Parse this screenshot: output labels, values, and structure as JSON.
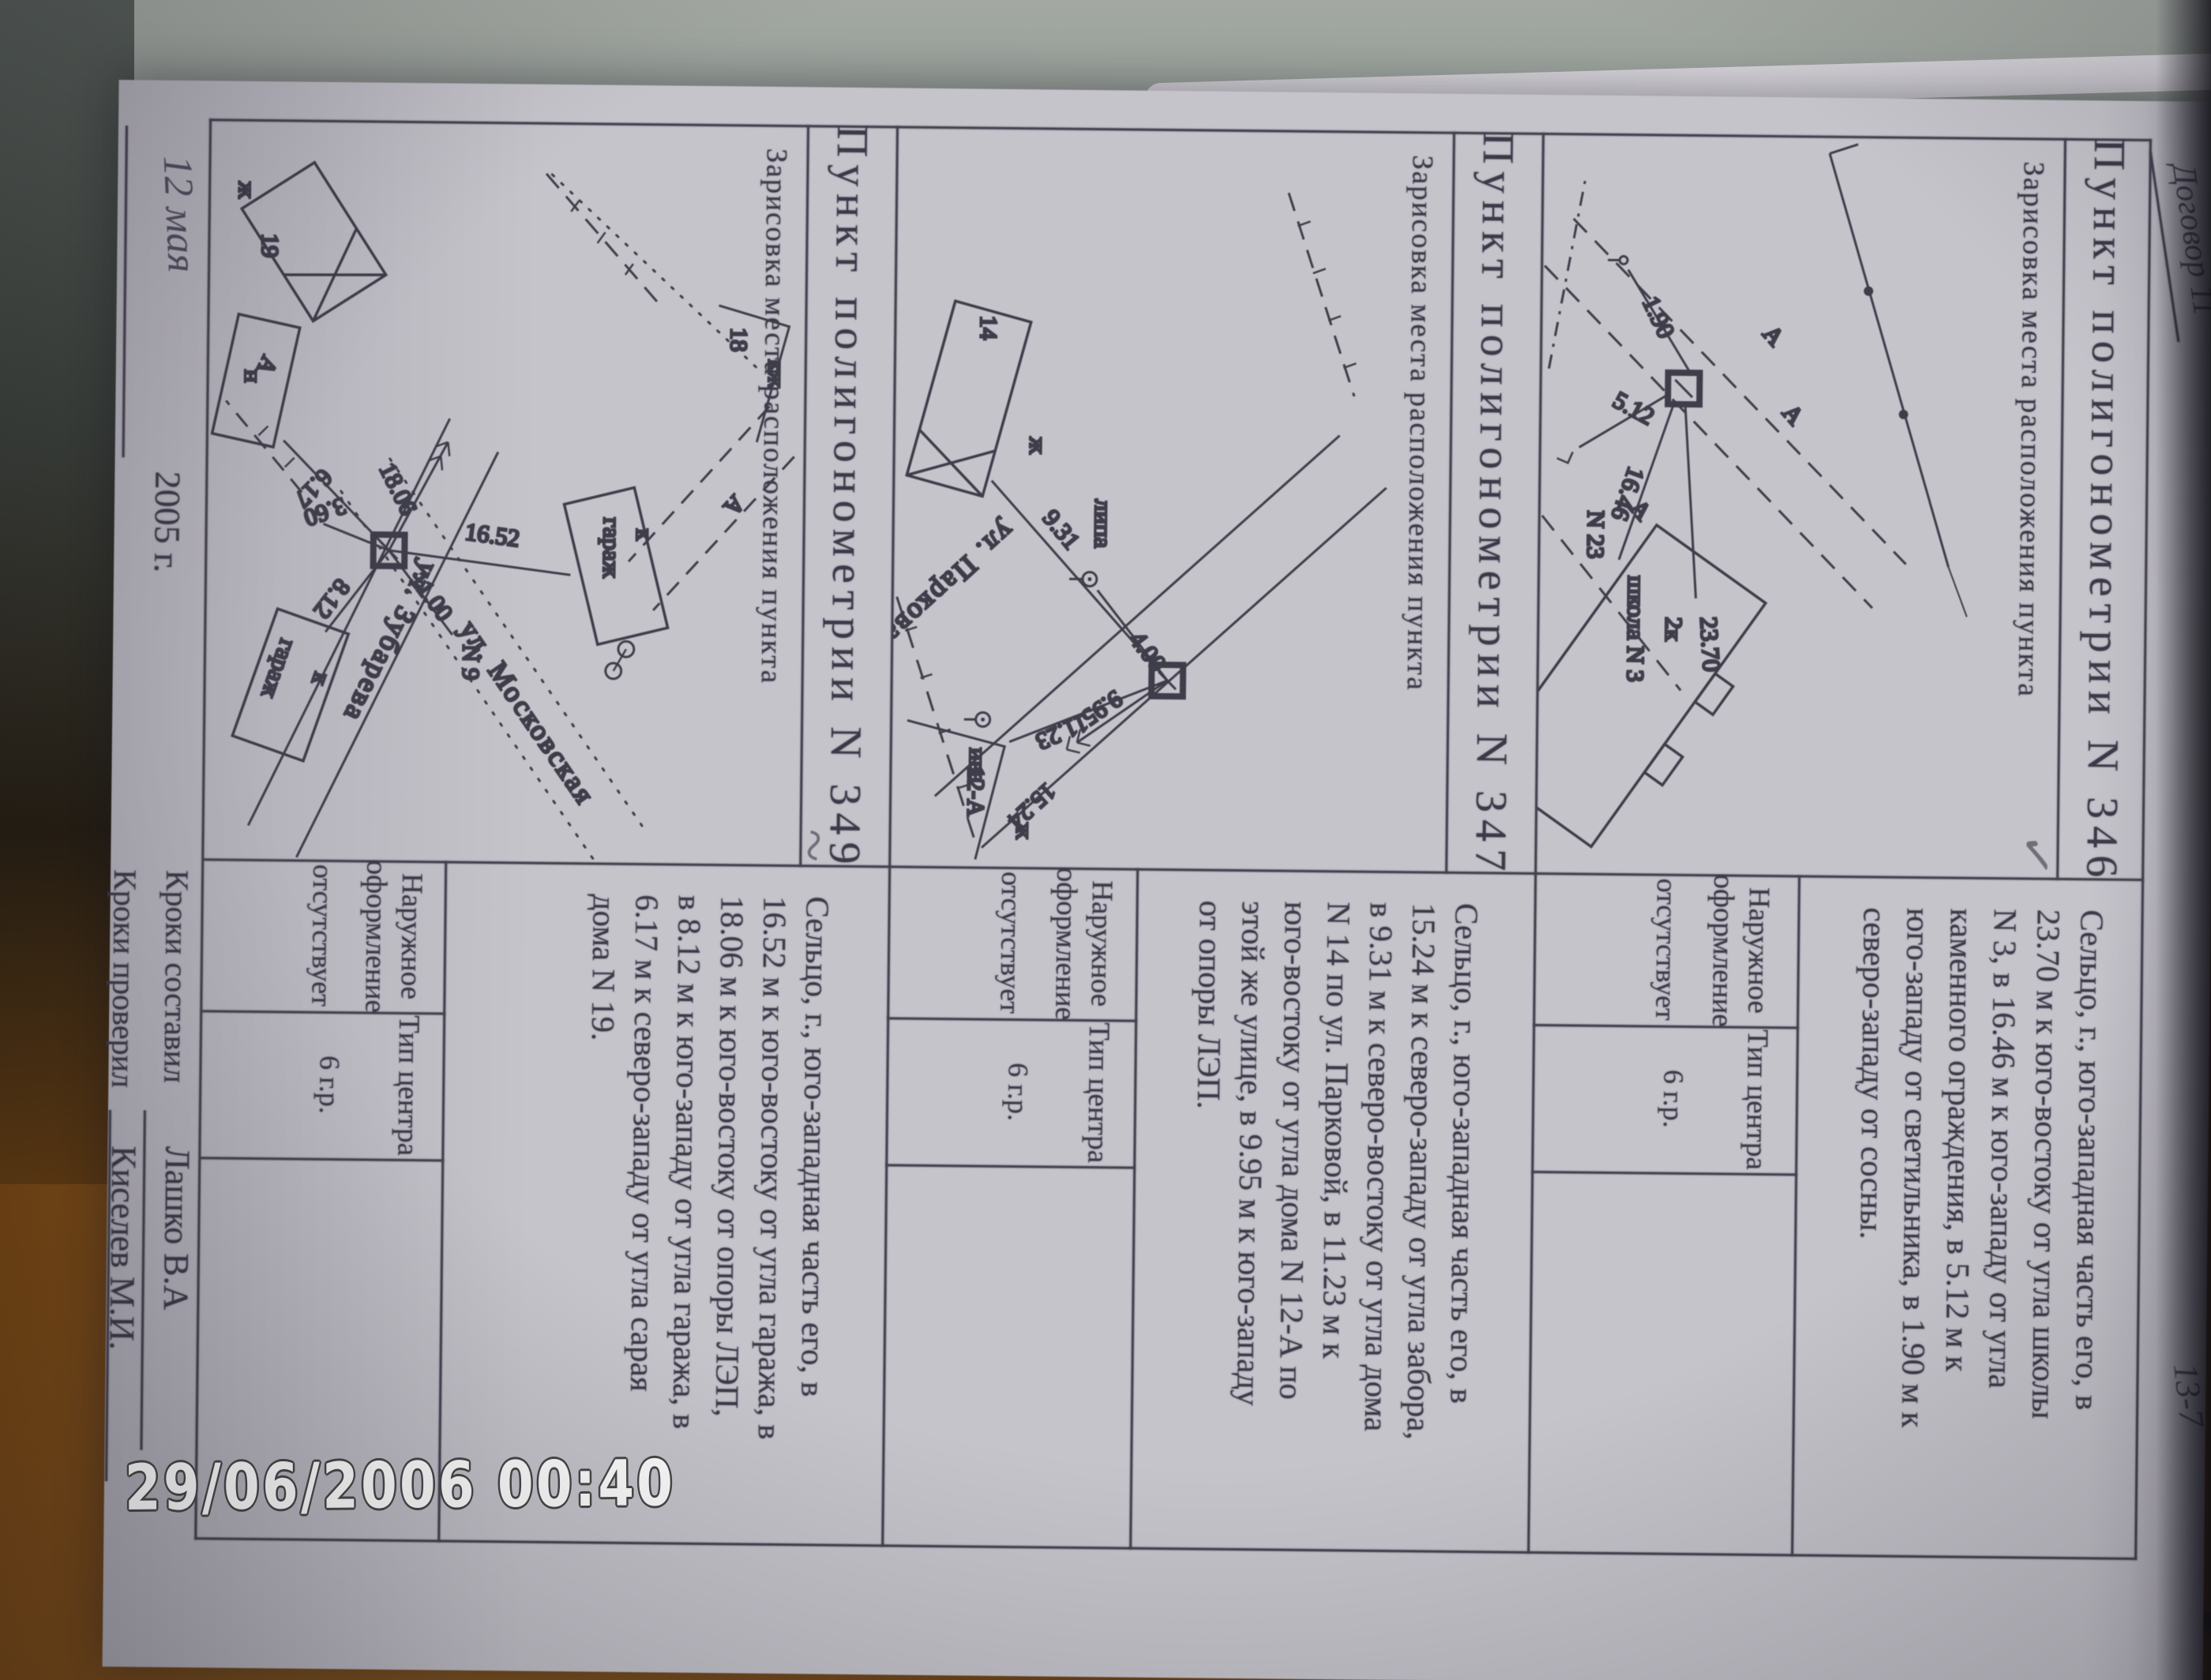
{
  "photo": {
    "timestamp": "29/06/2006  00:40"
  },
  "colors": {
    "page": "#c6c4cb",
    "ink": "#3b3a48",
    "wood": "#7d4a14",
    "background_top": "#99a09a",
    "timestamp_fill": "#fcfcfc"
  },
  "page": {
    "corner_note": "Договор 11",
    "page_number": "13-7",
    "footer": {
      "date": "12 мая",
      "year": "2005 г.",
      "made_label": "Кроки составил",
      "made_name": "Лашко В.А",
      "checked_label": "Кроки проверил",
      "checked_name": "Киселев М.И."
    },
    "records": [
      {
        "title": "Пункт полигонометрии N 346",
        "mark": "✓",
        "sketch_caption": "Зарисовка места расположения пункта",
        "description_lines": [
          "Сельцо, г., юго-западная часть его, в",
          "23.70 м к юго-востоку от угла школы",
          "N 3,  в 16.46 м к юго-западу от угла",
          "каменного ограждения, в 5.12 м к",
          "юго-западу от светильника, в 1.90 м к",
          "северо-западу от сосны."
        ],
        "outer_label_1": "Наружное",
        "outer_label_2": "оформление",
        "outer_value": "отсутствует",
        "center_label": "Тип центра",
        "center_value": "6 г.р.",
        "sketch_labels": {
          "d1": "23.70",
          "d2": "16.46",
          "d3": "5.12",
          "d4": "1.90",
          "a1": "А",
          "a2": "А",
          "a3": "А",
          "house_no": "N 23",
          "bld1": "2к",
          "bld2": "школа N 3"
        }
      },
      {
        "title": "Пункт полигонометрии N 347",
        "mark": "",
        "sketch_caption": "Зарисовка места расположения пункта",
        "description_lines": [
          "Сельцо, г., юго-западная часть его, в",
          "15.24 м к северо-западу от угла забора,",
          "в 9.31 м к северо-востоку от угла дома",
          "N 14 по ул. Парковой, в 11.23 м к",
          "юго-востоку от угла дома N 12-А по",
          "этой же улице, в 9.95 м к юго-западу",
          "от опоры ЛЭП."
        ],
        "outer_label_1": "Наружное",
        "outer_label_2": "оформление",
        "outer_value": "отсутствует",
        "center_label": "Тип центра",
        "center_value": "6 г.р.",
        "sketch_labels": {
          "b14": "14",
          "zh1": "ж",
          "d1": "9.31",
          "tree1": "липа",
          "d2": "4.00",
          "d3": "11.23",
          "b12": "12-А",
          "zh2": "ж",
          "d4": "9.95",
          "d5": "15.24",
          "tree2": "ива",
          "street": "ул. Парковая"
        }
      },
      {
        "title": "Пункт полигонометрии N 349",
        "mark": "~",
        "sketch_caption": "Зарисовка места расположения пункта",
        "description_lines": [
          "Сельцо, г., юго-западная часть его, в",
          "16.52 м к юго-востоку от угла гаража, в",
          "18.06 м к юго-востоку от опоры ЛЭП,",
          "в 8.12 м к юго-западу от угла гаража, в",
          "6.17 м к северо-западу от угла сарая",
          "дома N 19."
        ],
        "outer_label_1": "Наружное",
        "outer_label_2": "оформление",
        "outer_value": "отсутствует",
        "center_label": "Тип центра",
        "center_value": "6 г.р.",
        "sketch_labels": {
          "b18a": "кж",
          "b18": "18",
          "a1": "А",
          "g1k": "к",
          "g1": "гараж",
          "n9": "N 9",
          "d1": "16.52",
          "d2": "11.00",
          "d3": "18.06",
          "street1": "ул. Московская",
          "d4": "8.12",
          "d5": "3.60",
          "d6": "6.17",
          "g2k": "к",
          "g2": "гараж",
          "street2": "ул. Зубарева",
          "shed": "н",
          "b19": "19",
          "zh": "ж",
          "a2": "А"
        }
      }
    ]
  }
}
